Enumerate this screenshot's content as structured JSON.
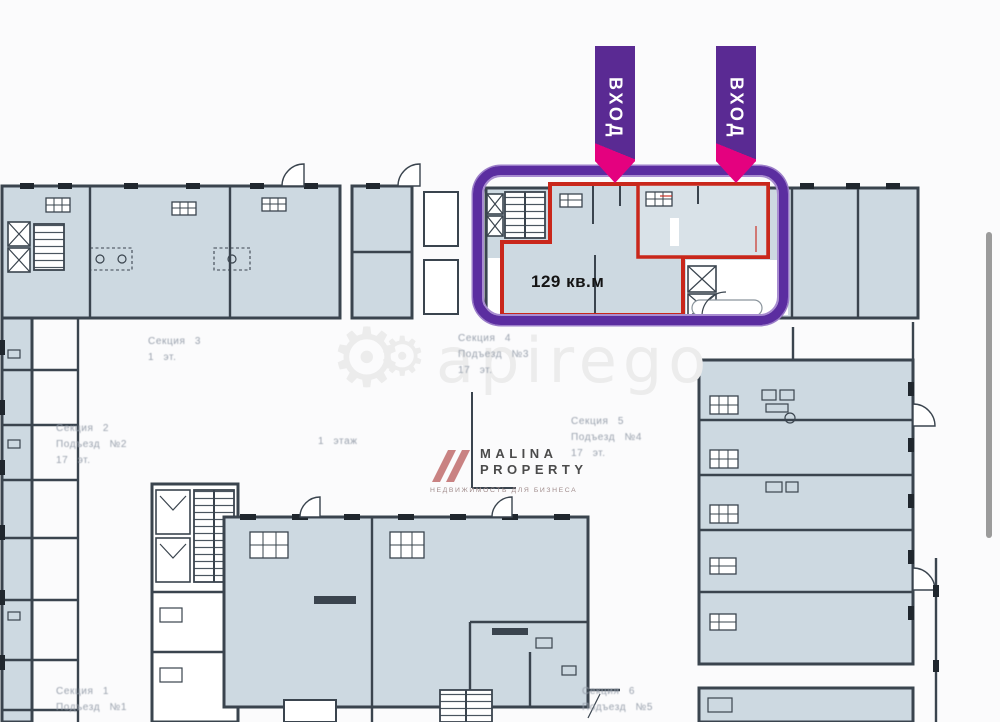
{
  "colors": {
    "bg": "#fbfbfc",
    "room-fill": "#cdd9e1",
    "room-fill-light": "#d9e2e8",
    "wall": "#3a444e",
    "wall-dark": "#20272e",
    "red": "#c9271b",
    "purple-frame": "#5b2da0",
    "purple-banner": "#5a2a93",
    "magenta": "#e4017f",
    "label": "#99a1ad",
    "watermark": "#ececec",
    "logo-rose": "#c98282",
    "logo-text": "#4b4b4b",
    "logo-tag": "#a18d8d",
    "scrollbar": "#9b9b9b"
  },
  "banners": [
    {
      "label": "ВХОД"
    },
    {
      "label": "ВХОД"
    }
  ],
  "unit": {
    "area": "129 кв.м"
  },
  "watermark": {
    "text": "apirego",
    "gear_icon": "⚙"
  },
  "logo": {
    "name_line1": "MALINA",
    "name_line2": "PROPERTY",
    "tagline": "НЕДВИЖИМОСТЬ ДЛЯ БИЗНЕСА"
  },
  "section_labels": [
    {
      "id": "section-3",
      "x": 148,
      "y": 334,
      "lines": [
        "Секция 3",
        "1 эт."
      ]
    },
    {
      "id": "section-4",
      "x": 458,
      "y": 331,
      "lines": [
        "Секция 4",
        "Подъезд №3",
        "17 эт."
      ]
    },
    {
      "id": "section-2",
      "x": 56,
      "y": 421,
      "lines": [
        "Секция 2",
        "Подъезд №2",
        "17 эт."
      ]
    },
    {
      "id": "section-5",
      "x": 571,
      "y": 414,
      "lines": [
        "Секция 5",
        "Подъезд №4",
        "17 эт."
      ]
    },
    {
      "id": "floor-1",
      "x": 318,
      "y": 434,
      "lines": [
        "1 этаж"
      ]
    },
    {
      "id": "section-1",
      "x": 56,
      "y": 684,
      "lines": [
        "Секция 1",
        "Подъезд №1"
      ]
    },
    {
      "id": "section-6",
      "x": 582,
      "y": 684,
      "lines": [
        "Секция 6",
        "Подъезд №5"
      ]
    }
  ]
}
